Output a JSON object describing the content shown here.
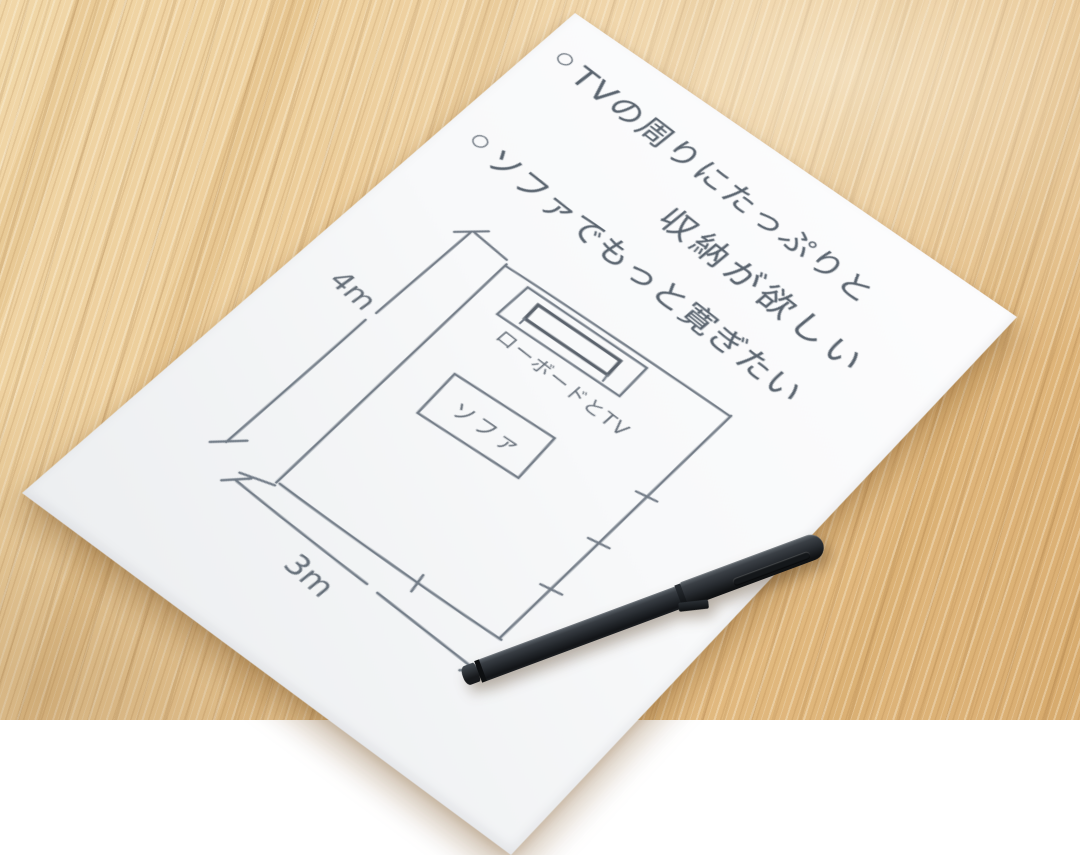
{
  "note": {
    "lines": [
      {
        "bullet": "○",
        "text": "TVの周りにたっぷりと"
      },
      {
        "text": "収納が欲しい"
      },
      {
        "bullet": "○",
        "text": "ソファでもっと寛ぎたい"
      }
    ]
  },
  "floor_plan": {
    "dim_height_label": "4m",
    "dim_width_label": "3m",
    "tv_board_label": "ローボードとTV",
    "sofa_label": "ソファ"
  },
  "colors": {
    "wood": "#e7c291",
    "paper": "#f8f9fa",
    "pencil_ink": "#59636e",
    "pen_body": "#24282d"
  }
}
